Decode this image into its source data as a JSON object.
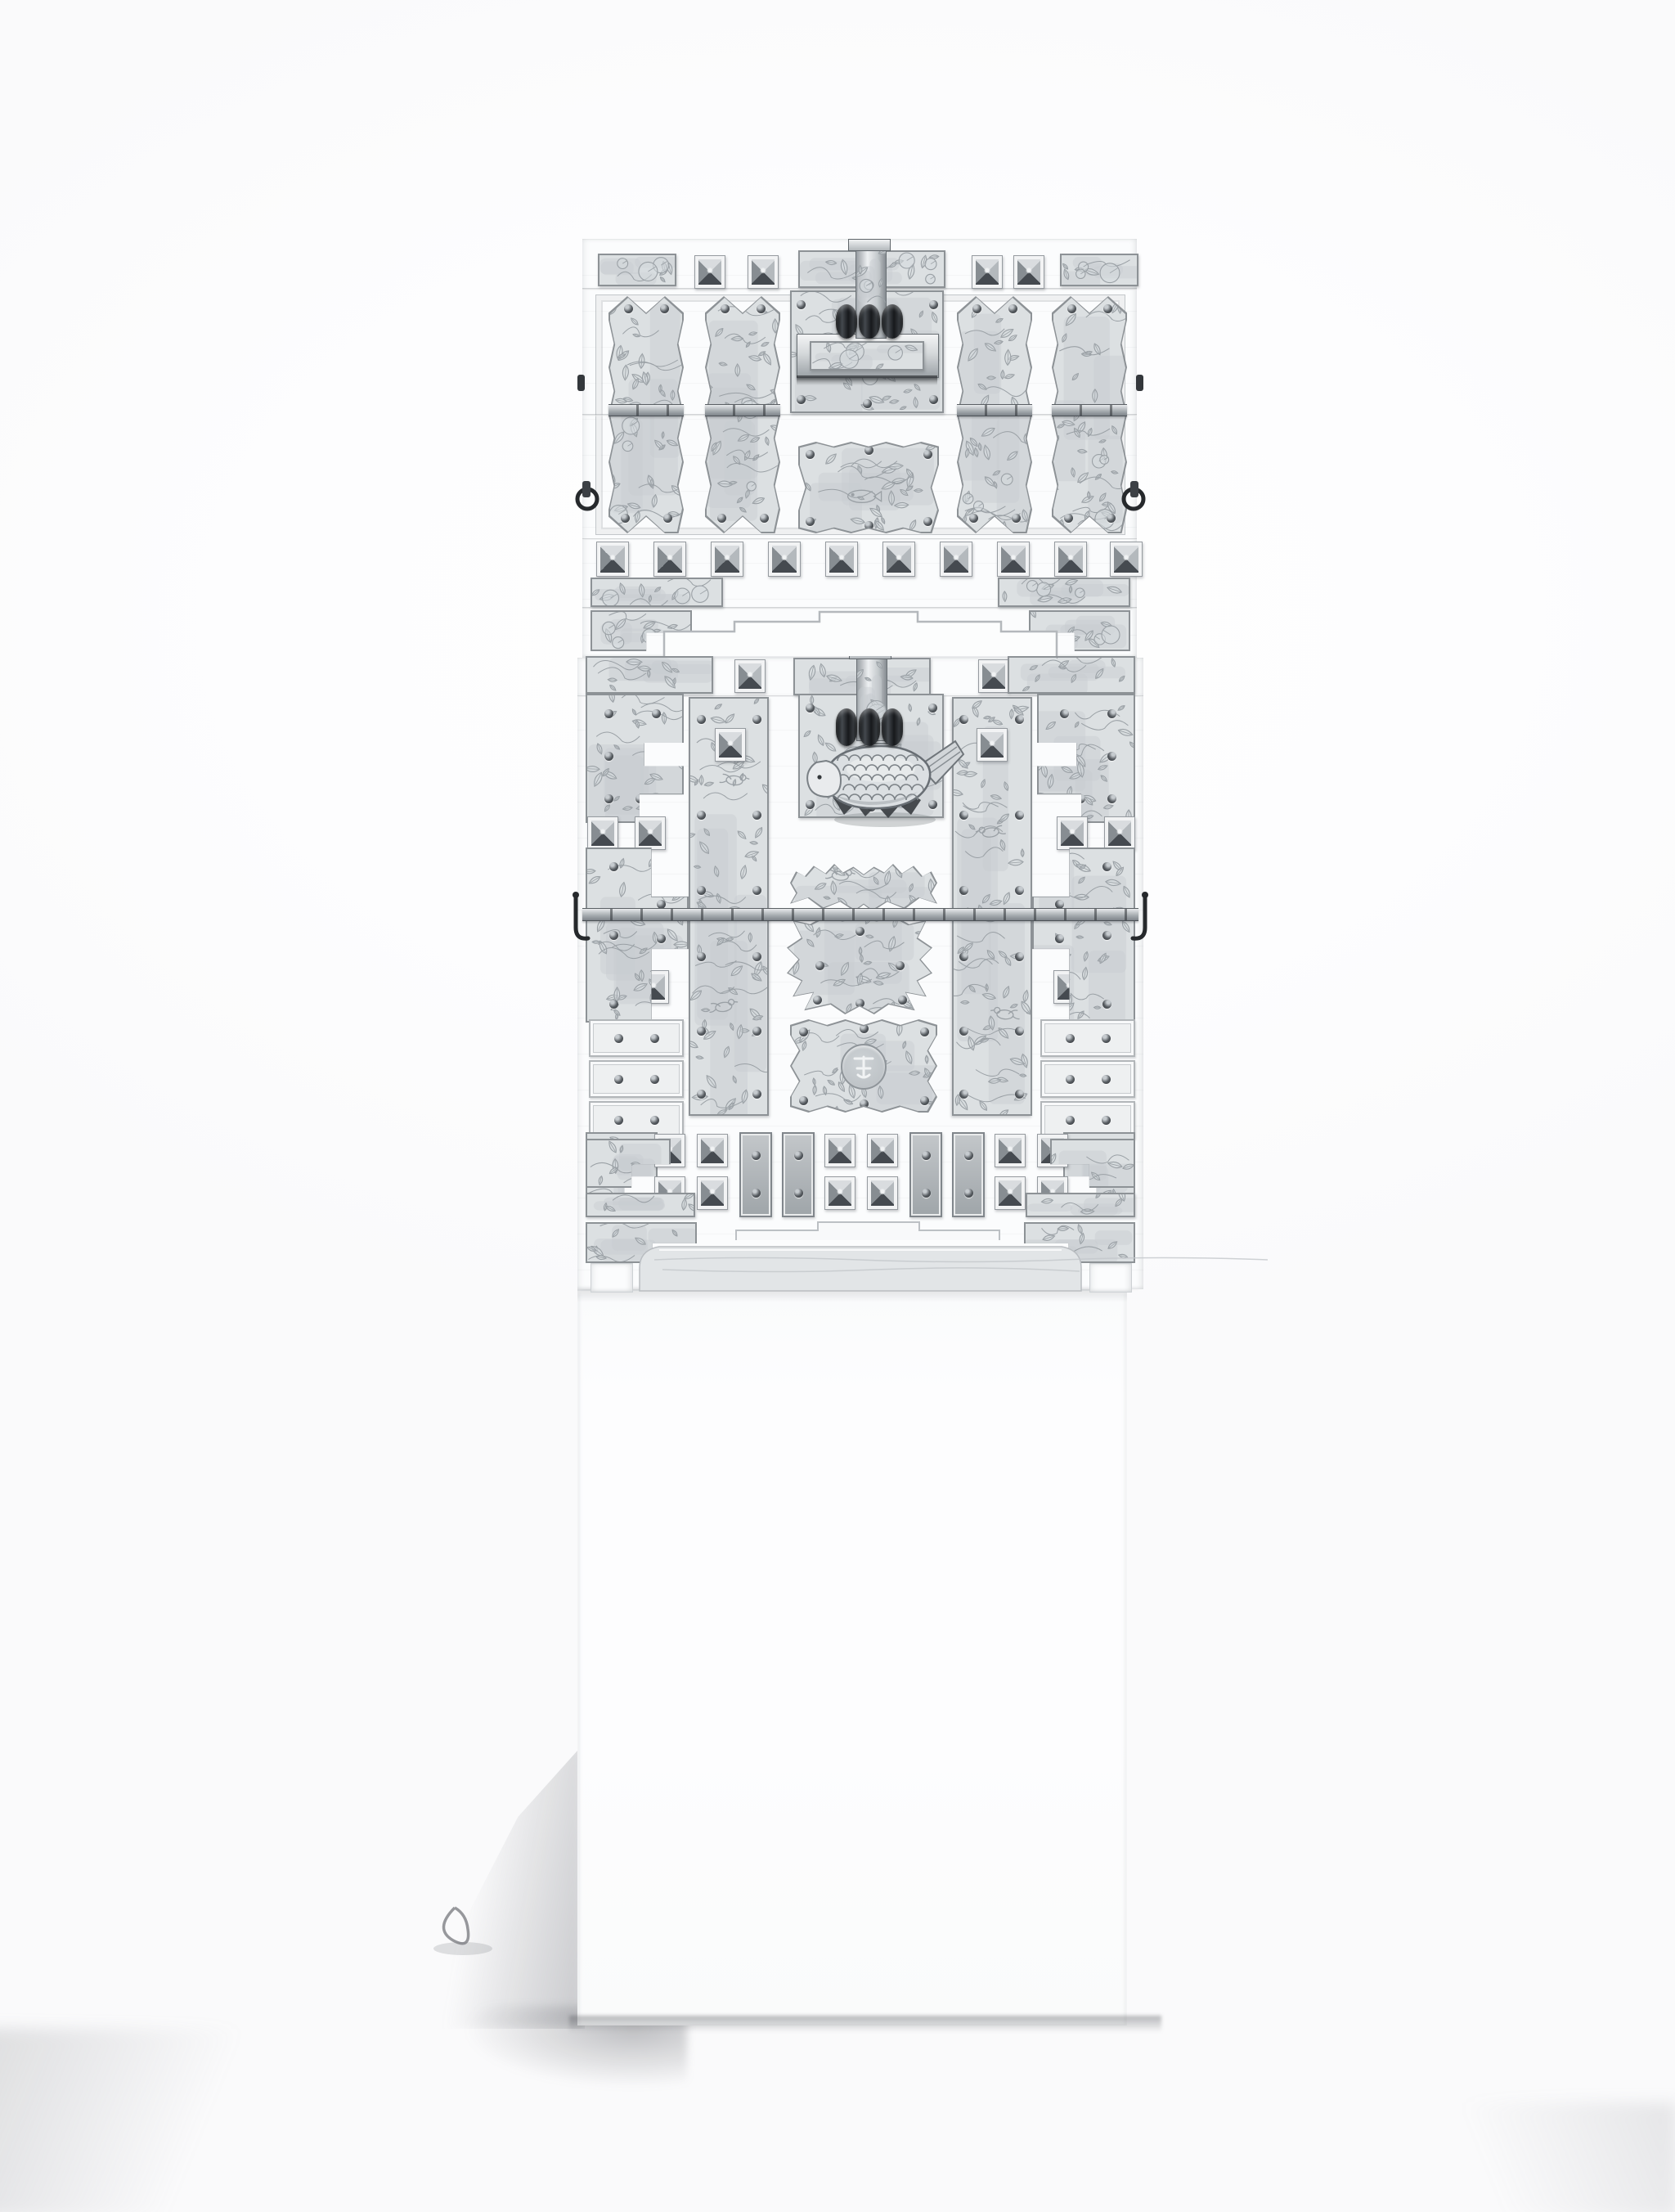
{
  "scene": {
    "description": "Black-and-white studio photograph of a two-tier Korean wedding chest densely mounted with engraved white-metal fittings, displayed on a plain white pedestal",
    "background": "plain white backdrop with soft floor shadows at lower corners"
  },
  "chest": {
    "upper_tier": {
      "top_rail": {
        "engraved_plates": 3,
        "pyramid_studs": 4,
        "hasp_cap": 1
      },
      "scalloped_strap_plates": 4,
      "lock_assembly": {
        "type": "hasp and lock bar",
        "barrel_knuckles": 3,
        "engraved_inset": "water-lily pond"
      },
      "pond_plate_motif": "fish and lotus pond",
      "side_handles": "dark round rings",
      "stud_row_count": 10,
      "corner_plates": 4
    },
    "lower_tier": {
      "door_panels": {
        "count": 2,
        "motif": "birds among foliage"
      },
      "padlock": {
        "shape": "fish",
        "detail": "scaled body, pale head, fanned tail",
        "barrel_knuckles": 3
      },
      "center_plates": [
        "winged plate",
        "shield plate",
        "scalloped medallion plate"
      ],
      "medallion": {
        "shape": "circle",
        "motif": "fortune ideograph"
      },
      "side_hooks": 2,
      "stepped_corner_plates": 4,
      "small_rivet_plates_per_side": 3,
      "bottom_hardware_row": {
        "stud_columns": 6,
        "vertical_slats": 4
      },
      "hinge_rows": 2,
      "apron": "carved skirt with short corner legs"
    },
    "motifs": [
      "lotus",
      "water-lily pond",
      "fish",
      "birds",
      "foliage",
      "fortune character"
    ]
  },
  "pedestal": {
    "shape": "rectangular plinth",
    "finish": "matte white"
  },
  "colors": {
    "background": "#fdfdfe",
    "wood": "#fbfcfd",
    "plate": "#dce0e2",
    "plateLight": "#eef0f1",
    "engrave": "#9aa0a5",
    "leafFill": "#d6dade",
    "mottle": "#c8cdd1",
    "frame": "#8d9296",
    "studLight": "#d9dcdf",
    "studDark": "#454a50",
    "studMidL": "#b4b9bd",
    "studMidD": "#878d92",
    "hardware": "#26292c",
    "rivet": "#3e4246",
    "seam": "#c3c7ca",
    "apron": "#e2e5e7",
    "pedestal": "#fcfcfd",
    "shadow": "#8e9096"
  }
}
